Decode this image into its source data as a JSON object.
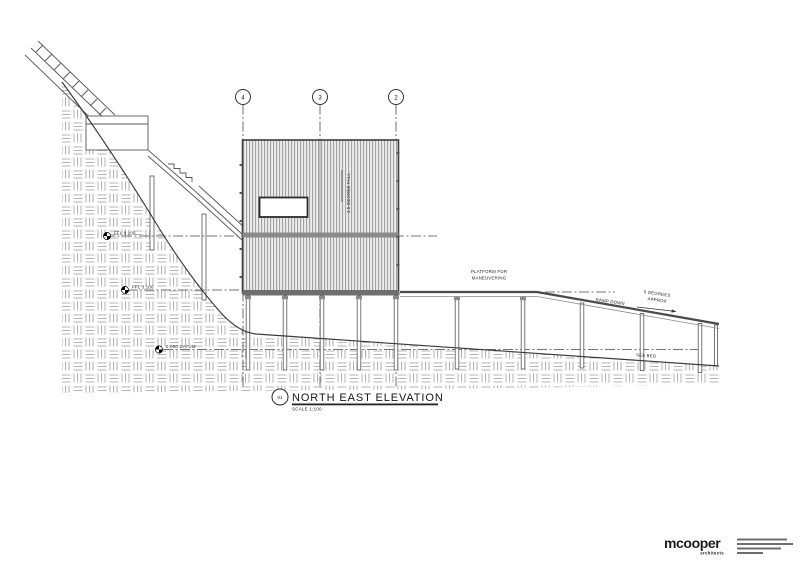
{
  "drawing": {
    "grids": [
      {
        "label": "4"
      },
      {
        "label": "3"
      },
      {
        "label": "2"
      }
    ],
    "levels": [
      {
        "label": "FFL  8.100"
      },
      {
        "label": "FFL  3.100"
      },
      {
        "label": "0.000  DATUM"
      }
    ],
    "annotations": {
      "fall": "1.5  DEGREE  FALL",
      "platform_line1": "PLATFORM  FOR",
      "platform_line2": "MANEUVERING",
      "ramp_down": "RAMP  DOWN",
      "degrees_line1": "5  DEGREES",
      "degrees_line2": "APPROX",
      "sea_bed": "SEA  BED"
    },
    "title_block": {
      "detail_number": "01",
      "title": "NORTH EAST ELEVATION",
      "scale": "SCALE  1:100"
    },
    "logo": {
      "name": "mcooper",
      "sub": "architects"
    }
  }
}
